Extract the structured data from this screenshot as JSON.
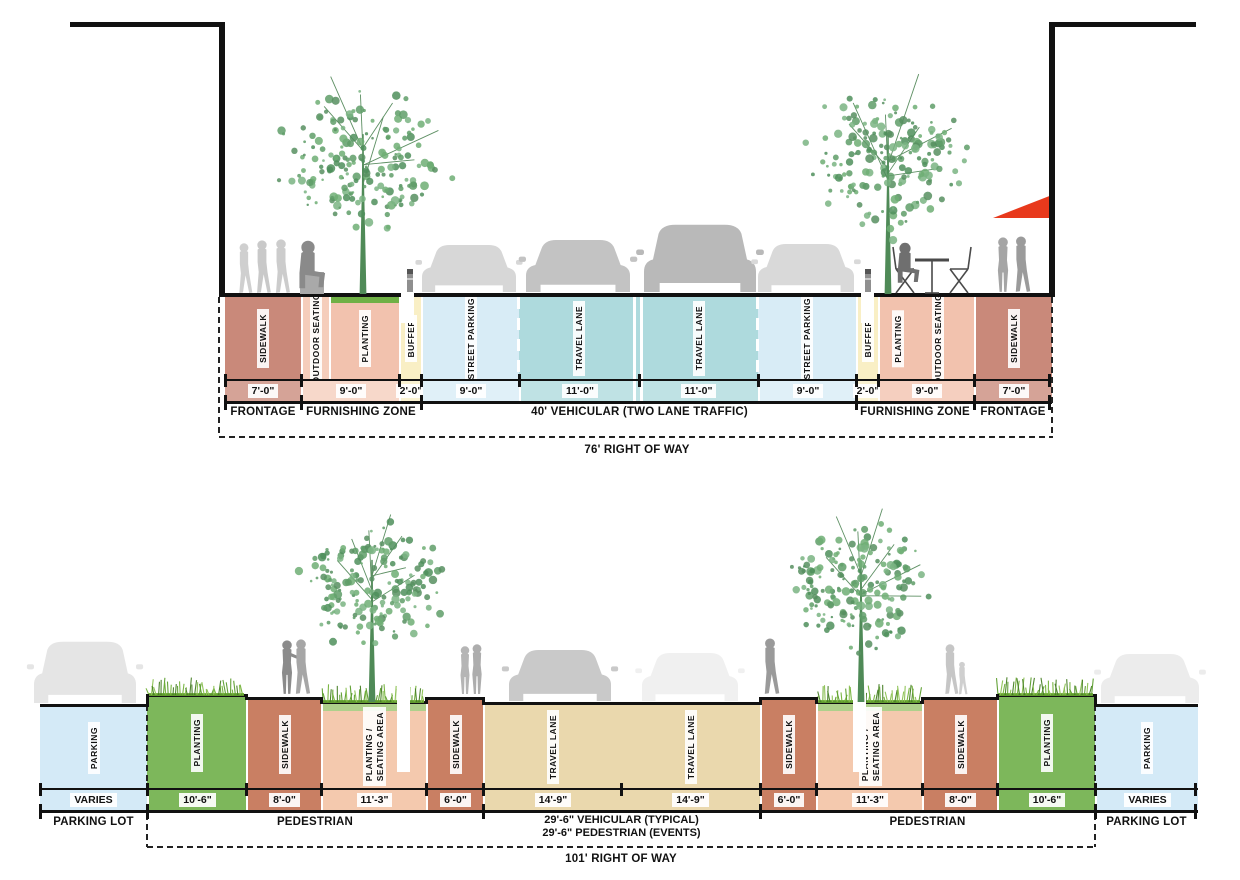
{
  "colors": {
    "top_sidewalk": "#c9897a",
    "top_outdoor_seating": "#f5cdbb",
    "top_planting": "#f2c2ae",
    "top_planting_cap": "#6fb045",
    "top_buffer": "#f9efc5",
    "top_street_parking": "#d8ecf6",
    "top_travel_lane": "#aedadd",
    "bottom_parking": "#d4eaf7",
    "bottom_planting": "#7db75b",
    "bottom_sidewalk": "#c97f63",
    "bottom_planting_seating": "#f4c9ae",
    "bottom_planting_seating_cap": "#aed08b",
    "bottom_travel_lane": "#ead8ad",
    "tree_green": "#5f9e68",
    "grass_green": "#74b33a",
    "awning_red": "#e8391c",
    "line_black": "#111111",
    "figure_gray": "#aaaaaa"
  },
  "top": {
    "row_label": "76'  RIGHT OF WAY",
    "zones": [
      {
        "label": "SIDEWALK"
      },
      {
        "label": "OUTDOOR SEATING"
      },
      {
        "label": "PLANTING"
      },
      {
        "label": "BUFFER"
      },
      {
        "label": "STREET PARKING"
      },
      {
        "label": "TRAVEL LANE"
      },
      {
        "label": "TRAVEL LANE"
      },
      {
        "label": "STREET PARKING"
      },
      {
        "label": "BUFFER"
      },
      {
        "label": "PLANTING"
      },
      {
        "label": "OUTDOOR SEATING"
      },
      {
        "label": "SIDEWALK"
      }
    ],
    "dims": [
      {
        "value": "7'-0\""
      },
      {
        "value": "9'-0\""
      },
      {
        "value": "2'-0\""
      },
      {
        "value": "9'-0\""
      },
      {
        "value": "11'-0\""
      },
      {
        "value": "11'-0\""
      },
      {
        "value": "9'-0\""
      },
      {
        "value": "2'-0\""
      },
      {
        "value": "9'-0\""
      },
      {
        "value": "7'-0\""
      }
    ],
    "groups": [
      {
        "label": "FRONTAGE"
      },
      {
        "label": "FURNISHING ZONE"
      },
      {
        "label": "40' VEHICULAR (TWO LANE TRAFFIC)"
      },
      {
        "label": "FURNISHING ZONE"
      },
      {
        "label": "FRONTAGE"
      }
    ]
  },
  "bottom": {
    "row_label": "101'  RIGHT OF WAY",
    "zones": [
      {
        "label": "PARKING"
      },
      {
        "label": "PLANTING"
      },
      {
        "label": "SIDEWALK"
      },
      {
        "label": "PLANTING /",
        "label2": "SEATING AREA"
      },
      {
        "label": "SIDEWALK"
      },
      {
        "label": "TRAVEL LANE"
      },
      {
        "label": "TRAVEL LANE"
      },
      {
        "label": "SIDEWALK"
      },
      {
        "label": "PLANTING /",
        "label2": "SEATING AREA"
      },
      {
        "label": "SIDEWALK"
      },
      {
        "label": "PLANTING"
      },
      {
        "label": "PARKING"
      }
    ],
    "dims": [
      {
        "value": "VARIES"
      },
      {
        "value": "10'-6\""
      },
      {
        "value": "8'-0\""
      },
      {
        "value": "11'-3\""
      },
      {
        "value": "6'-0\""
      },
      {
        "value": "14'-9\""
      },
      {
        "value": "14'-9\""
      },
      {
        "value": "6'-0\""
      },
      {
        "value": "11'-3\""
      },
      {
        "value": "8'-0\""
      },
      {
        "value": "10'-6\""
      },
      {
        "value": "VARIES"
      }
    ],
    "groups": [
      {
        "label": "PARKING LOT"
      },
      {
        "label": "PEDESTRIAN"
      },
      {
        "line1": "29'-6\" VEHICULAR (TYPICAL)",
        "line2": "29'-6\" PEDESTRIAN (EVENTS)"
      },
      {
        "label": "PEDESTRIAN"
      },
      {
        "label": "PARKING LOT"
      }
    ]
  }
}
